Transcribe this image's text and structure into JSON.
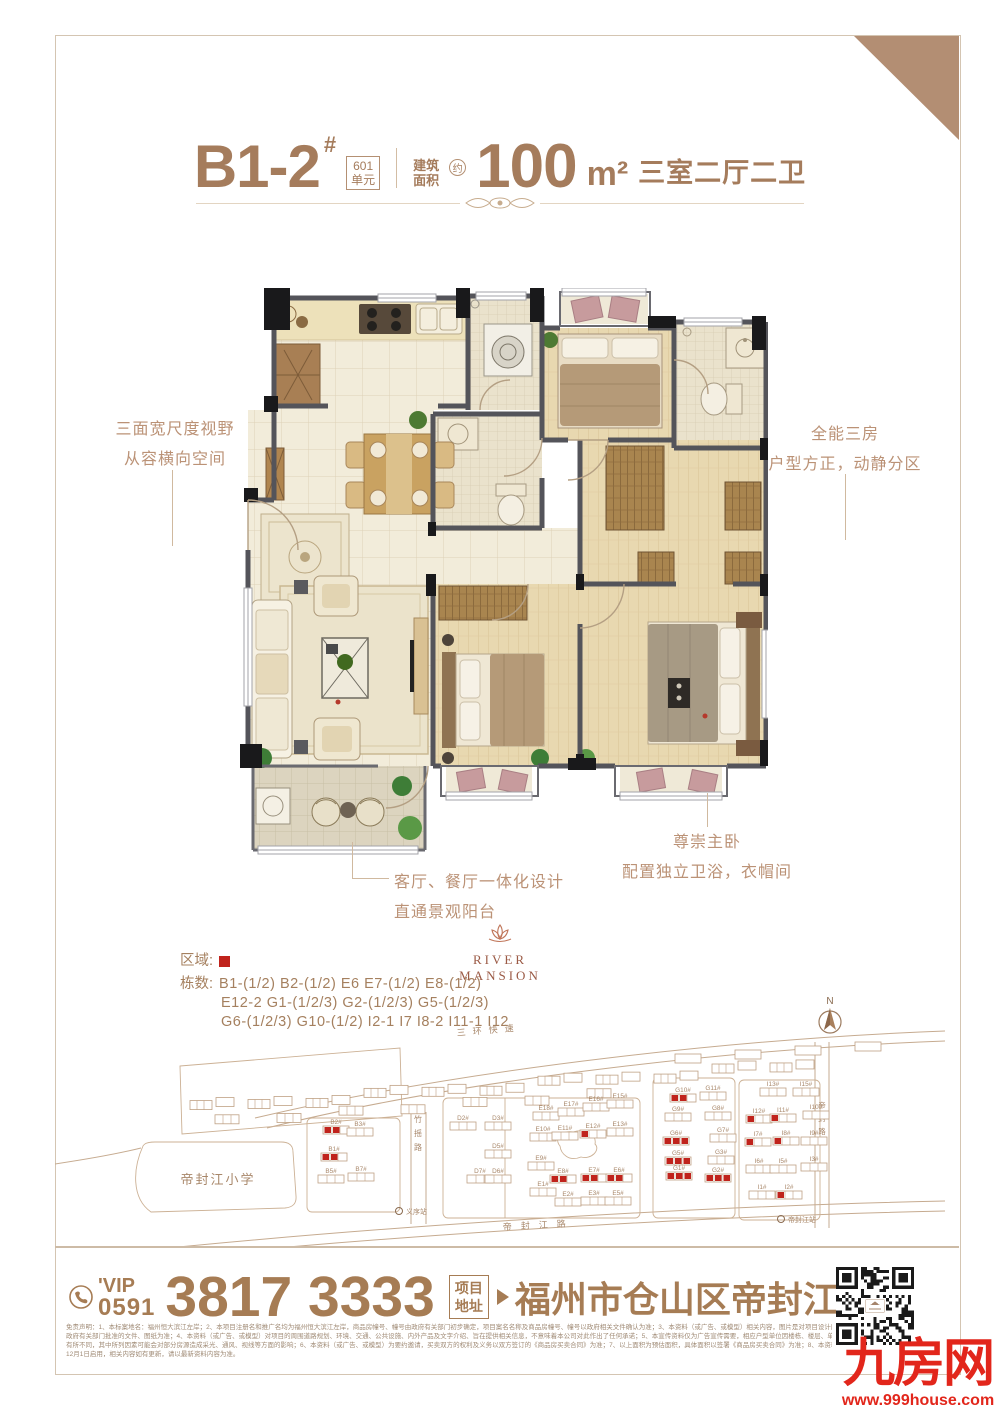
{
  "colors": {
    "accent_brown": "#a57c5c",
    "light_brown": "#bb9276",
    "map_line": "#c3a78c",
    "highlight_red": "#c0231c",
    "logo_red": "#e2261b",
    "wall_gray": "#54545a"
  },
  "header": {
    "unit_code": "B1-2",
    "unit_sup": "#",
    "unit_box_line1": "601",
    "unit_box_line2": "单元",
    "area_label_line1": "建筑",
    "area_label_line2": "面积",
    "area_approx": "约",
    "area_value": "100",
    "area_unit": "m²",
    "layout_text": "三室二厅二卫"
  },
  "callouts": {
    "left_line1": "三面宽尺度视野",
    "left_line2": "从容横向空间",
    "right_line1": "全能三房",
    "right_line2": "户型方正，动静分区",
    "bottom_left_line1": "客厅、餐厅一体化设计",
    "bottom_left_line2": "直通景观阳台",
    "bottom_right_line1": "尊崇主卧",
    "bottom_right_line2": "配置独立卫浴，衣帽间"
  },
  "brand": {
    "name": "RIVER MANSION"
  },
  "legend": {
    "area_label": "区域:",
    "blocks_label": "栋数:",
    "lines": [
      "B1-(1/2)  B2-(1/2)  E6  E7-(1/2)  E8-(1/2)",
      "E12-2  G1-(1/2/3)  G2-(1/2/3)  G5-(1/2/3)",
      "G6-(1/2/3)  G10-(1/2)  I2-1  I7  I8-2  I11-1  I12"
    ]
  },
  "map": {
    "compass_label": "N",
    "school": "帝封江小学",
    "road_top": "三环快速",
    "road_left": "竹摇路",
    "road_bottom": "帝封江路",
    "road_right": "帝封路",
    "station_left": "义序站",
    "station_right": "帝封江站",
    "buildings": [
      {
        "l": "B2#",
        "x": 268,
        "y": 106,
        "r": 2
      },
      {
        "l": "B3#",
        "x": 292,
        "y": 108,
        "r": 0
      },
      {
        "l": "B1#",
        "x": 266,
        "y": 133,
        "r": 2
      },
      {
        "l": "B5#",
        "x": 263,
        "y": 155,
        "r": 0
      },
      {
        "l": "B7#",
        "x": 293,
        "y": 153,
        "r": 0
      },
      {
        "l": "D2#",
        "x": 395,
        "y": 102,
        "r": 0
      },
      {
        "l": "D3#",
        "x": 430,
        "y": 102,
        "r": 0
      },
      {
        "l": "D5#",
        "x": 430,
        "y": 130,
        "r": 0
      },
      {
        "l": "D7#",
        "x": 412,
        "y": 155,
        "r": 0
      },
      {
        "l": "D6#",
        "x": 430,
        "y": 155,
        "r": 0
      },
      {
        "l": "E18#",
        "x": 478,
        "y": 92,
        "r": 0
      },
      {
        "l": "E17#",
        "x": 503,
        "y": 88,
        "r": 0
      },
      {
        "l": "E16#",
        "x": 528,
        "y": 83,
        "r": 0
      },
      {
        "l": "E15#",
        "x": 552,
        "y": 80,
        "r": 0
      },
      {
        "l": "E10#",
        "x": 475,
        "y": 113,
        "r": 0
      },
      {
        "l": "E11#",
        "x": 497,
        "y": 112,
        "r": 0
      },
      {
        "l": "E12#",
        "x": 525,
        "y": 110,
        "r": 1
      },
      {
        "l": "E13#",
        "x": 552,
        "y": 108,
        "r": 0
      },
      {
        "l": "E9#",
        "x": 473,
        "y": 142,
        "r": 0
      },
      {
        "l": "E8#",
        "x": 495,
        "y": 155,
        "r": 2
      },
      {
        "l": "E7#",
        "x": 526,
        "y": 154,
        "r": 2
      },
      {
        "l": "E6#",
        "x": 551,
        "y": 154,
        "r": 2
      },
      {
        "l": "E1#",
        "x": 475,
        "y": 168,
        "r": 0
      },
      {
        "l": "E2#",
        "x": 500,
        "y": 178,
        "r": 0
      },
      {
        "l": "E3#",
        "x": 526,
        "y": 177,
        "r": 0
      },
      {
        "l": "E5#",
        "x": 550,
        "y": 177,
        "r": 0
      },
      {
        "l": "G10#",
        "x": 615,
        "y": 74,
        "r": 2
      },
      {
        "l": "G11#",
        "x": 645,
        "y": 72,
        "r": 0
      },
      {
        "l": "G9#",
        "x": 610,
        "y": 93,
        "r": 0
      },
      {
        "l": "G8#",
        "x": 650,
        "y": 92,
        "r": 0
      },
      {
        "l": "G6#",
        "x": 608,
        "y": 117,
        "r": 3
      },
      {
        "l": "G7#",
        "x": 655,
        "y": 114,
        "r": 0
      },
      {
        "l": "G5#",
        "x": 610,
        "y": 137,
        "r": 3
      },
      {
        "l": "G3#",
        "x": 653,
        "y": 136,
        "r": 0
      },
      {
        "l": "G1#",
        "x": 611,
        "y": 152,
        "r": 3
      },
      {
        "l": "G2#",
        "x": 650,
        "y": 154,
        "r": 3
      },
      {
        "l": "I13#",
        "x": 705,
        "y": 68,
        "r": 0
      },
      {
        "l": "I15#",
        "x": 738,
        "y": 68,
        "r": 0
      },
      {
        "l": "I12#",
        "x": 691,
        "y": 95,
        "r": 1
      },
      {
        "l": "I11#",
        "x": 715,
        "y": 94,
        "r": 1
      },
      {
        "l": "I10#",
        "x": 748,
        "y": 91,
        "r": 0
      },
      {
        "l": "I7#",
        "x": 690,
        "y": 118,
        "r": 1
      },
      {
        "l": "I8#",
        "x": 718,
        "y": 117,
        "r": 1
      },
      {
        "l": "I9#",
        "x": 746,
        "y": 117,
        "r": 0
      },
      {
        "l": "I6#",
        "x": 691,
        "y": 145,
        "r": 0
      },
      {
        "l": "I5#",
        "x": 715,
        "y": 145,
        "r": 0
      },
      {
        "l": "I3#",
        "x": 746,
        "y": 143,
        "r": 0
      },
      {
        "l": "I1#",
        "x": 694,
        "y": 171,
        "r": 0
      },
      {
        "l": "I2#",
        "x": 721,
        "y": 171,
        "r": 1
      }
    ]
  },
  "contact": {
    "vip": "'VIP",
    "area_code": "0591",
    "phone": "3817 3333",
    "address_box_line1": "项目",
    "address_box_line2": "地址",
    "address": "福州市仓山区帝封江"
  },
  "footer_logo": {
    "name": "九房网",
    "url": "www.999house.com"
  },
  "disclaimer": [
    "免责声明：1、本标案地名：福州恒大滨江左岸；2、本项目注册名和推广名均为福州恒大滨江左岸，商品房幢号、幢号由政府有关部门初步确定，项目案名名称及商品房幢号、幢号以政府相关文件确认为准；3、本资料（或广告、或模型）相关内容，图片是对项目设计所做的示意表现，仅供参考，最终以",
    "政府有关部门批准的文件、图纸为准；4、本资料（或广告、或模型）对项目的周围道路规划、环境、交通、公共设施、内外产品及文字介绍、旨在提供相关信息，不意味着本公司对此作出了任何承诺；5、本宣传资料仅为广告宣传需要，相应户型单位因楼栋、楼层、单元不同，局部结构、面积等可能",
    "有所不同，其中所列因素可能会对部分房源造成采光、通风、视线等方面的影响；6、本资料（或广告、或模型）为要约邀请，买卖双方的权利及义务以双方签订的《商品房买卖合同》为准；7、以上面积为预估面积，具体面积以签署《商品房买卖合同》为准；8、本资料（或广告、或模型）2020年",
    "12月1日启用，相关内容如有更新，请以最新资料内容为准。"
  ]
}
